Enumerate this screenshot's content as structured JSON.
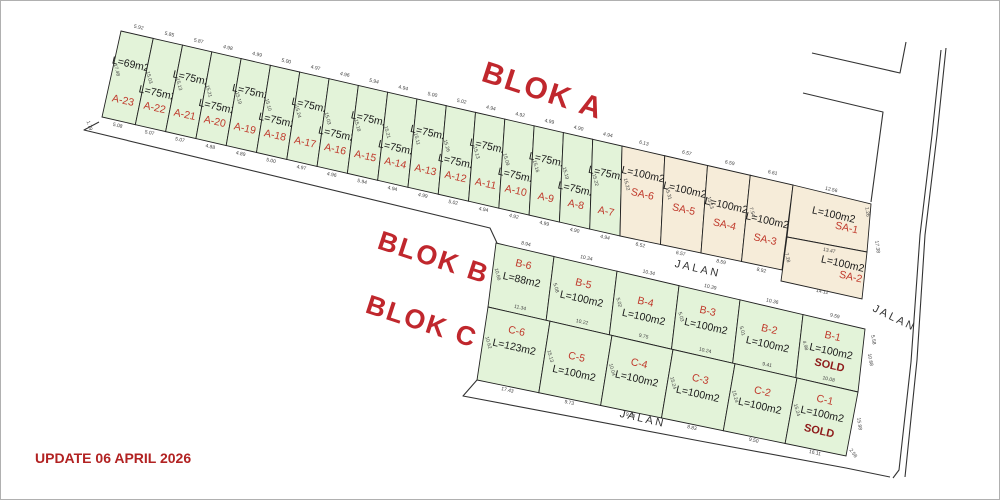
{
  "page": {
    "background": "#ffffff",
    "border_color": "#b0b0b0"
  },
  "update_note": {
    "text": "UPDATE 06 APRIL 2026",
    "color": "#b22222"
  },
  "colors": {
    "lot_green": "#e3f3d9",
    "lot_beige": "#f6ecd9",
    "lot_stroke": "#222222",
    "id_red": "#c0392b",
    "sold_maroon": "#8e1b1b",
    "dim_gray": "#444444",
    "title_red": "#c0272d",
    "road_text": "#333333"
  },
  "titles": [
    {
      "text": "BLOK A",
      "x": 540,
      "y": 100,
      "r": 18,
      "size": 30
    },
    {
      "text": "BLOK B",
      "x": 431,
      "y": 266,
      "r": 18,
      "size": 27
    },
    {
      "text": "BLOK C",
      "x": 419,
      "y": 330,
      "r": 18,
      "size": 27
    }
  ],
  "road_labels": [
    {
      "text": "JALAN",
      "x": 697,
      "y": 272,
      "r": 13
    },
    {
      "text": "JALAN",
      "x": 893,
      "y": 321,
      "r": 26
    },
    {
      "text": "JALAN",
      "x": 642,
      "y": 422,
      "r": 13
    }
  ],
  "strips": [
    {
      "name": "blok-a",
      "fill": "lot_green",
      "lots": [
        {
          "id": "A-23",
          "area": "L=69m2",
          "top": "5.92",
          "side": "17.48",
          "bot": "5.08"
        },
        {
          "id": "A-22",
          "area": "L=75m2",
          "top": "5.85",
          "side": "15.03",
          "bot": "5.07"
        },
        {
          "id": "A-21",
          "area": "L=75m2",
          "top": "5.87",
          "side": "15.13",
          "bot": "5.07"
        },
        {
          "id": "A-20",
          "area": "L=75m2",
          "top": "4.98",
          "side": "15.21",
          "bot": "4.88"
        },
        {
          "id": "A-19",
          "area": "L=75m2",
          "top": "4.99",
          "side": "15.19",
          "bot": "4.89"
        },
        {
          "id": "A-18",
          "area": "L=75m2",
          "top": "5.00",
          "side": "15.10",
          "bot": "5.00"
        },
        {
          "id": "A-17",
          "area": "L=75m2",
          "top": "4.97",
          "side": "15.24",
          "bot": "4.97"
        },
        {
          "id": "A-16",
          "area": "L=75m2",
          "top": "4.96",
          "side": "15.03",
          "bot": "4.96"
        },
        {
          "id": "A-15",
          "area": "L=75m2",
          "top": "5.94",
          "side": "15.18",
          "bot": "5.94"
        },
        {
          "id": "A-14",
          "area": "L=75m2",
          "top": "4.94",
          "side": "15.21",
          "bot": "4.94"
        },
        {
          "id": "A-13",
          "area": "L=75m2",
          "top": "5.00",
          "side": "15.11",
          "bot": "4.99"
        },
        {
          "id": "A-12",
          "area": "L=75m2",
          "top": "5.02",
          "side": "15.26",
          "bot": "5.02"
        },
        {
          "id": "A-11",
          "area": "L=75m2",
          "top": "4.94",
          "side": "15.13",
          "bot": "4.94"
        },
        {
          "id": "A-10",
          "area": "L=75m2",
          "top": "4.92",
          "side": "15.09",
          "bot": "4.92"
        },
        {
          "id": "A-9",
          "area": "L=75m2",
          "top": "4.99",
          "side": "15.16",
          "bot": "4.99"
        },
        {
          "id": "A-8",
          "area": "L=75m2",
          "top": "4.90",
          "side": "15.19",
          "bot": "4.90"
        },
        {
          "id": "A-7",
          "area": "L=75m2",
          "top": "4.94",
          "side": "15.22",
          "bot": "4.94"
        }
      ]
    },
    {
      "name": "blok-sa",
      "fill": "lot_beige",
      "lots": [
        {
          "id": "SA-6",
          "area": "L=100m2",
          "top": "6.13",
          "side": "15.22",
          "bot": "6.52"
        },
        {
          "id": "SA-5",
          "area": "L=100m2",
          "top": "6.57",
          "side": "15.31",
          "bot": "6.57"
        },
        {
          "id": "SA-4",
          "area": "L=100m2",
          "top": "6.59",
          "side": "15.13",
          "bot": "8.59"
        },
        {
          "id": "SA-3",
          "area": "L=100m2",
          "top": "6.61",
          "side": "7.54",
          "bot": "8.92"
        }
      ]
    },
    {
      "name": "blok-sa12",
      "fill": "lot_beige",
      "lots": [
        {
          "id": "SA-1",
          "area": "L=100m2"
        },
        {
          "id": "SA-2",
          "area": "L=100m2"
        }
      ]
    },
    {
      "name": "blok-b",
      "fill": "lot_green",
      "lots": [
        {
          "id": "B-6",
          "area": "L=88m2",
          "top": "8.94",
          "side": "10.66"
        },
        {
          "id": "B-5",
          "area": "L=100m2",
          "top": "10.34",
          "side": "5.08"
        },
        {
          "id": "B-4",
          "area": "L=100m2",
          "top": "10.34",
          "side": "5.02"
        },
        {
          "id": "B-3",
          "area": "L=100m2",
          "top": "10.39",
          "side": "5.03"
        },
        {
          "id": "B-2",
          "area": "L=100m2",
          "top": "10.36",
          "side": "5.01"
        },
        {
          "id": "B-1",
          "area": "L=100m2",
          "top": "9.59",
          "side": "4.98",
          "sold": "SOLD"
        }
      ]
    },
    {
      "name": "blok-c",
      "fill": "lot_green",
      "lots": [
        {
          "id": "C-6",
          "area": "L=123m2",
          "top": "11.34",
          "side": "10.62",
          "bot": "17.43"
        },
        {
          "id": "C-5",
          "area": "L=100m2",
          "top": "10.22",
          "side": "15.13",
          "bot": "9.73",
          "flip": true
        },
        {
          "id": "C-4",
          "area": "L=100m2",
          "top": "9.75",
          "side": "10.04",
          "bot": "9.76"
        },
        {
          "id": "C-3",
          "area": "L=100m2",
          "top": "10.24",
          "side": "15.24",
          "bot": "8.83"
        },
        {
          "id": "C-2",
          "area": "L=100m2",
          "top": "9.41",
          "side": "15.24",
          "bot": "9.50"
        },
        {
          "id": "C-1",
          "area": "L=100m2",
          "top": "10.08",
          "side": "15.24",
          "bot": "16.11",
          "sold": "SOLD"
        }
      ]
    }
  ],
  "extra_dims": [
    {
      "t": "1.79",
      "x": 88,
      "y": 126,
      "r": 72
    },
    {
      "t": "12.56",
      "x": 831,
      "y": 191,
      "r": 13
    },
    {
      "t": "13.47",
      "x": 829,
      "y": 252,
      "r": 11
    },
    {
      "t": "14.12",
      "x": 822,
      "y": 293,
      "r": 11
    },
    {
      "t": "17.38",
      "x": 876,
      "y": 247,
      "r": 82
    },
    {
      "t": "1.26",
      "x": 866,
      "y": 212,
      "r": 82
    },
    {
      "t": "7.28",
      "x": 786,
      "y": 258,
      "r": 75
    },
    {
      "t": "10.68",
      "x": 869,
      "y": 360,
      "r": 80
    },
    {
      "t": "15.98",
      "x": 858,
      "y": 424,
      "r": 82
    },
    {
      "t": "2.58",
      "x": 852,
      "y": 454,
      "r": 55
    },
    {
      "t": "5.58",
      "x": 872,
      "y": 340,
      "r": 80
    }
  ]
}
